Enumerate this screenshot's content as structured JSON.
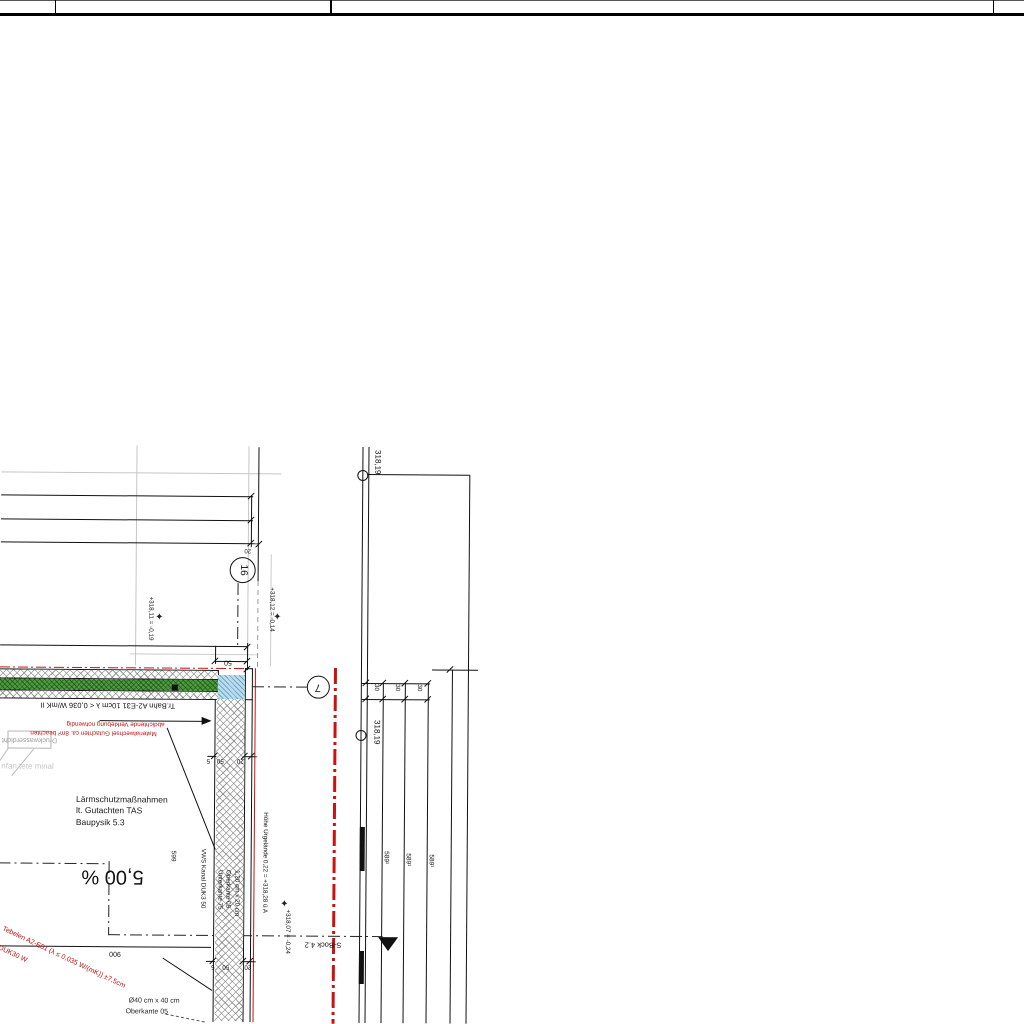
{
  "sheet": {
    "kind": "architectural-section-detail",
    "background": "#ffffff"
  },
  "colors": {
    "ink": "#111111",
    "red": "#c11212",
    "gray": "#9a9a9a",
    "faint": "#c4c4c4",
    "green_layer": "#4f9c40",
    "blue_block": "#badcef"
  },
  "title_block": {
    "top_rule_y": 0,
    "main_rule_y": 13,
    "dividers_x": [
      55,
      330,
      993
    ]
  },
  "texts": [
    {
      "n": "laermschutz-note",
      "t": "Lärmschutzmaßnahmen\nlt. Gutachten TAS\nBaupysik 5.3",
      "x": 77,
      "y": 797,
      "rot": 0,
      "fs": 8.5,
      "c": "#1a1a1a",
      "align": "l",
      "lh": 1.35
    },
    {
      "n": "slope-label",
      "t": "5,00 %",
      "x": 114,
      "y": 879,
      "rot": 180,
      "fs": 20,
      "c": "#111111",
      "align": "c"
    },
    {
      "n": "spec-trennbahn",
      "t": "Tr.Bahn A2-E31 10cm λ < 0,036 W/mK II",
      "x": 108,
      "y": 708,
      "rot": 180,
      "fs": 7.5,
      "c": "#111111",
      "align": "c"
    },
    {
      "n": "red-note-line1",
      "t": "abdichtende Verklebung notwendig",
      "x": 116,
      "y": 726,
      "rot": 180,
      "fs": 6.3,
      "c": "#c11212",
      "align": "c"
    },
    {
      "n": "red-note-line2",
      "t": "Materialwechsel Gutachten ca. 8m² beachten",
      "x": 94,
      "y": 735,
      "rot": 180,
      "fs": 6.3,
      "c": "#c11212",
      "align": "c"
    },
    {
      "n": "druckwasser-label",
      "t": "Druckwasserdicht",
      "x": 30,
      "y": 743,
      "rot": 180,
      "fs": 7,
      "c": "#9a9a9a",
      "align": "c"
    },
    {
      "n": "faint-ghost-text",
      "t": "nfan tete minal",
      "x": 2,
      "y": 766,
      "rot": 0,
      "fs": 8,
      "c": "#c4c4c4",
      "align": "l"
    },
    {
      "n": "red-diag-spec",
      "t": "Tebelen A2-E51 (λ ≤ 0,035 W/(mK)) ±7,5cm",
      "x": 6,
      "y": 929,
      "rot": 25,
      "fs": 7,
      "c": "#c11212",
      "align": "l"
    },
    {
      "n": "red-diag-spec2",
      "t": "DUK30 W",
      "x": 2,
      "y": 948,
      "rot": 25,
      "fs": 7,
      "c": "#c11212",
      "align": "l"
    },
    {
      "n": "dim-900",
      "t": "900",
      "x": 117,
      "y": 956,
      "rot": 180,
      "fs": 7,
      "c": "#111111",
      "align": "c"
    },
    {
      "n": "dim-50",
      "t": "50",
      "x": 228,
      "y": 664,
      "rot": 180,
      "fs": 7,
      "c": "#111111",
      "align": "c"
    },
    {
      "n": "dim-20-top",
      "t": "20",
      "x": 247,
      "y": 552,
      "rot": 180,
      "fs": 6,
      "c": "#111111",
      "align": "c"
    },
    {
      "n": "wall-dim-5a",
      "t": "5",
      "x": 209,
      "y": 762,
      "rot": 180,
      "fs": 6.3,
      "c": "#111111",
      "align": "c"
    },
    {
      "n": "wall-dim-50a",
      "t": "50",
      "x": 221,
      "y": 762,
      "rot": 180,
      "fs": 6.3,
      "c": "#111111",
      "align": "c"
    },
    {
      "n": "wall-dim-20a",
      "t": "20",
      "x": 241,
      "y": 762,
      "rot": 180,
      "fs": 6.3,
      "c": "#111111",
      "align": "c"
    },
    {
      "n": "wall-dim-5b",
      "t": "5",
      "x": 215,
      "y": 968,
      "rot": 180,
      "fs": 6.3,
      "c": "#111111",
      "align": "c"
    },
    {
      "n": "wall-dim-50b",
      "t": "50",
      "x": 228,
      "y": 968,
      "rot": 180,
      "fs": 6.3,
      "c": "#111111",
      "align": "c"
    },
    {
      "n": "wall-dim-20b",
      "t": "20",
      "x": 250,
      "y": 968,
      "rot": 180,
      "fs": 6.3,
      "c": "#111111",
      "align": "c"
    },
    {
      "n": "marker-16-label",
      "t": "16",
      "x": 242,
      "y": 572,
      "rot": 90,
      "fs": 10,
      "c": "#111111",
      "align": "c"
    },
    {
      "n": "marker-7-label",
      "t": "7",
      "x": 318,
      "y": 688,
      "rot": 180,
      "fs": 11,
      "c": "#111111",
      "align": "c"
    },
    {
      "n": "level-318-19-a",
      "t": "318,19",
      "x": 380,
      "y": 451,
      "rot": 90,
      "fs": 8,
      "c": "#111111",
      "align": "l"
    },
    {
      "n": "level-318-19-b",
      "t": "318,19",
      "x": 381,
      "y": 721,
      "rot": 90,
      "fs": 8,
      "c": "#111111",
      "align": "l"
    },
    {
      "n": "datum-left",
      "t": "+318,11 = -0,19",
      "x": 153,
      "y": 599,
      "rot": 90,
      "fs": 6.3,
      "c": "#111111",
      "align": "l"
    },
    {
      "n": "datum-right",
      "t": "+318,12 = -0,14",
      "x": 274,
      "y": 589,
      "rot": 90,
      "fs": 6.3,
      "c": "#111111",
      "align": "l"
    },
    {
      "n": "hoehe-urgelaende",
      "t": "Höhe Urgelände 0,22 = +318,28 ü A",
      "x": 269,
      "y": 814,
      "rot": 90,
      "fs": 6.3,
      "c": "#111111",
      "align": "l"
    },
    {
      "n": "datum-low",
      "t": "+318,07 = -0,24",
      "x": 292,
      "y": 911,
      "rot": 90,
      "fs": 6.3,
      "c": "#111111",
      "align": "l"
    },
    {
      "n": "dim-30-a",
      "t": "30",
      "x": 379,
      "y": 685,
      "rot": 90,
      "fs": 6.3,
      "c": "#111111",
      "align": "l"
    },
    {
      "n": "dim-30-b",
      "t": "30",
      "x": 400,
      "y": 685,
      "rot": 90,
      "fs": 6.3,
      "c": "#111111",
      "align": "l"
    },
    {
      "n": "dim-30-c",
      "t": "30",
      "x": 422,
      "y": 685,
      "rot": 90,
      "fs": 6.3,
      "c": "#111111",
      "align": "l"
    },
    {
      "n": "level-589-a",
      "t": "589¹",
      "x": 390,
      "y": 852,
      "rot": 90,
      "fs": 6.5,
      "c": "#111111",
      "align": "l"
    },
    {
      "n": "level-589-b",
      "t": "589¹",
      "x": 412,
      "y": 854,
      "rot": 90,
      "fs": 6.5,
      "c": "#111111",
      "align": "l"
    },
    {
      "n": "level-589-c",
      "t": "589¹",
      "x": 435,
      "y": 855,
      "rot": 90,
      "fs": 6.5,
      "c": "#111111",
      "align": "l"
    },
    {
      "n": "level-599",
      "t": "599",
      "x": 177,
      "y": 853,
      "rot": 90,
      "fs": 6.5,
      "c": "#111111",
      "align": "l"
    },
    {
      "n": "vws-kanal-label",
      "t": "VWS Kanal DUK3 50",
      "x": 207,
      "y": 851,
      "rot": 90,
      "fs": 6.3,
      "c": "#111111",
      "align": "l"
    },
    {
      "n": "wall-column-label",
      "t": "1,20 cm x 20 cm\nOberkante 05\nUnterkante 75",
      "x": 242,
      "y": 872,
      "rot": 90,
      "fs": 6.3,
      "c": "#111111",
      "align": "l",
      "lh": 1.35
    },
    {
      "n": "section-label",
      "t": "S-Bock 4.2",
      "x": 325,
      "y": 946,
      "rot": 180,
      "fs": 7.5,
      "c": "#111111",
      "align": "c"
    },
    {
      "n": "footing-size-label",
      "t": "Ø40 cm x 40 cm",
      "x": 131,
      "y": 1000,
      "rot": 0,
      "fs": 7,
      "c": "#222222",
      "align": "l"
    },
    {
      "n": "footing-okante-label",
      "t": "Oberkante 05",
      "x": 128,
      "y": 1011,
      "rot": 0,
      "fs": 7,
      "c": "#222222",
      "align": "l"
    }
  ],
  "lines": [
    {
      "n": "title-top-rule",
      "x": 0,
      "y": 0,
      "l": 1024,
      "w": 1,
      "o": "h",
      "c": "#555"
    },
    {
      "n": "title-main-rule",
      "x": 0,
      "y": 13,
      "l": 1024,
      "w": 2.5,
      "o": "h",
      "c": "#000"
    },
    {
      "n": "title-divider-1",
      "x": 55,
      "y": 0,
      "l": 14,
      "w": 1,
      "o": "v",
      "c": "#000"
    },
    {
      "n": "title-divider-2",
      "x": 330,
      "y": 0,
      "l": 14,
      "w": 1.5,
      "o": "v",
      "c": "#000"
    },
    {
      "n": "title-divider-3",
      "x": 993,
      "y": 0,
      "l": 14,
      "w": 1,
      "o": "v",
      "c": "#000"
    },
    {
      "n": "grid-gray-v1",
      "x": 135,
      "y": 448,
      "l": 220,
      "w": 1,
      "o": "v",
      "c": "#c6c6c6"
    },
    {
      "n": "grid-gray-v2",
      "x": 247,
      "y": 448,
      "l": 222,
      "w": 1,
      "o": "v",
      "c": "#c6c6c6"
    },
    {
      "n": "grid-gray-v3",
      "x": 270,
      "y": 556,
      "l": 112,
      "w": 1,
      "o": "v",
      "c": "#cccccc"
    },
    {
      "n": "grid-gray-h1",
      "x": 0,
      "y": 475,
      "l": 280,
      "w": 1,
      "o": "h",
      "c": "#c6c6c6"
    },
    {
      "n": "grid-gray-h2",
      "x": 130,
      "y": 656,
      "l": 128,
      "w": 1,
      "o": "h",
      "c": "#cccccc"
    },
    {
      "n": "ramp-line-1",
      "x": 0,
      "y": 498,
      "l": 252,
      "w": 1.2,
      "o": "h",
      "c": "#111"
    },
    {
      "n": "ramp-line-2",
      "x": 0,
      "y": 522,
      "l": 252,
      "w": 1.2,
      "o": "h",
      "c": "#111"
    },
    {
      "n": "ramp-line-3",
      "x": 0,
      "y": 545,
      "l": 258,
      "w": 1.2,
      "o": "h",
      "c": "#111"
    },
    {
      "n": "ramp-dim-v",
      "x": 250,
      "y": 497,
      "l": 52,
      "w": 1,
      "o": "v",
      "c": "#111"
    },
    {
      "n": "ramp-edge-v",
      "x": 257,
      "y": 449,
      "l": 134,
      "w": 1.2,
      "o": "v",
      "c": "#111"
    },
    {
      "n": "ramp-edge-dash",
      "x": 257,
      "y": 583,
      "l": 88,
      "w": 1,
      "o": "v",
      "c": "#999",
      "d": "graydashv"
    },
    {
      "n": "axis-dashdot-16",
      "x": 237,
      "y": 585,
      "l": 63,
      "w": 1,
      "o": "v",
      "c": "#222",
      "d": "dashdotv"
    },
    {
      "n": "floor-top-line",
      "x": 0,
      "y": 648,
      "l": 247,
      "w": 1,
      "o": "h",
      "c": "#111"
    },
    {
      "n": "dim-50-line",
      "x": 215,
      "y": 663,
      "l": 32,
      "w": 1,
      "o": "h",
      "c": "#111"
    },
    {
      "n": "ext-v-215",
      "x": 215,
      "y": 648,
      "l": 18,
      "w": 1,
      "o": "v",
      "c": "#111"
    },
    {
      "n": "ext-v-247",
      "x": 247,
      "y": 645,
      "l": 27,
      "w": 1,
      "o": "v",
      "c": "#111"
    },
    {
      "n": "band-red-top",
      "x": 0,
      "y": 670,
      "l": 250,
      "w": 1.4,
      "o": "h",
      "c": "#c11",
      "d": "reddashdot"
    },
    {
      "n": "band-border-1",
      "x": 0,
      "y": 672,
      "l": 218,
      "w": 1,
      "o": "h",
      "c": "#111"
    },
    {
      "n": "band-border-2",
      "x": 0,
      "y": 681,
      "l": 218,
      "w": 1,
      "o": "h",
      "c": "#111"
    },
    {
      "n": "band-border-3",
      "x": 0,
      "y": 693,
      "l": 246,
      "w": 1,
      "o": "h",
      "c": "#111"
    },
    {
      "n": "band-border-4",
      "x": 0,
      "y": 701,
      "l": 253,
      "w": 1.2,
      "o": "h",
      "c": "#111"
    },
    {
      "n": "band-corner-h",
      "x": 245,
      "y": 670,
      "l": 8,
      "w": 1,
      "o": "h",
      "c": "#111"
    },
    {
      "n": "band-arrow-line",
      "x": 170,
      "y": 683,
      "l": 48,
      "w": 1.2,
      "o": "h",
      "c": "#111"
    },
    {
      "n": "blue-border-l",
      "x": 218,
      "y": 672,
      "l": 29,
      "w": 1,
      "o": "v",
      "c": "#111"
    },
    {
      "n": "blue-border-r",
      "x": 245,
      "y": 670,
      "l": 31,
      "w": 1,
      "o": "v",
      "c": "#111"
    },
    {
      "n": "band-border-r2",
      "x": 252,
      "y": 670,
      "l": 31,
      "w": 1.2,
      "o": "v",
      "c": "#111"
    },
    {
      "n": "leader-red-note",
      "x": 100,
      "y": 723,
      "l": 105,
      "w": 1,
      "o": "h",
      "c": "#111"
    },
    {
      "n": "wall-face-left",
      "x": 215,
      "y": 701,
      "l": 323,
      "w": 1.2,
      "o": "v",
      "c": "#111"
    },
    {
      "n": "wall-line-245",
      "x": 245,
      "y": 701,
      "l": 323,
      "w": 1,
      "o": "v",
      "c": "#111"
    },
    {
      "n": "wall-face-right",
      "x": 252,
      "y": 701,
      "l": 323,
      "w": 1.2,
      "o": "v",
      "c": "#111"
    },
    {
      "n": "wall-red-seal",
      "x": 255,
      "y": 670,
      "l": 354,
      "w": 1.4,
      "o": "v",
      "c": "#c11"
    },
    {
      "n": "wall-axis-dashdot",
      "x": 231,
      "y": 700,
      "l": 324,
      "w": 1,
      "o": "v",
      "c": "#222",
      "d": "dashdotv"
    },
    {
      "n": "wall-dim-line-a",
      "x": 208,
      "y": 758,
      "l": 50,
      "w": 1,
      "o": "h",
      "c": "#111"
    },
    {
      "n": "wall-dim-line-b",
      "x": 208,
      "y": 963,
      "l": 50,
      "w": 1,
      "o": "h",
      "c": "#111"
    },
    {
      "n": "marker7-leader",
      "x": 252,
      "y": 688,
      "l": 55,
      "w": 1,
      "o": "h",
      "c": "#222",
      "d": "dashdot"
    },
    {
      "n": "boundary-red-bold",
      "x": 334,
      "y": 669,
      "l": 356,
      "w": 2.6,
      "o": "v",
      "c": "#c11",
      "d": "reddashdotv"
    },
    {
      "n": "level-line-1",
      "x": 361,
      "y": 448,
      "l": 576,
      "w": 1.2,
      "o": "v",
      "c": "#111"
    },
    {
      "n": "level-line-2",
      "x": 367,
      "y": 448,
      "l": 576,
      "w": 1,
      "o": "v",
      "c": "#111"
    },
    {
      "n": "level-bold-seg1",
      "x": 361,
      "y": 828,
      "l": 44,
      "w": 5,
      "o": "v",
      "c": "#111"
    },
    {
      "n": "level-bold-seg2",
      "x": 361,
      "y": 952,
      "l": 33,
      "w": 5,
      "o": "v",
      "c": "#111"
    },
    {
      "n": "level-top-h",
      "x": 366,
      "y": 475,
      "l": 102,
      "w": 1,
      "o": "h",
      "c": "#111"
    },
    {
      "n": "right-edge-v",
      "x": 468,
      "y": 475,
      "l": 549,
      "w": 1.2,
      "o": "v",
      "c": "#111"
    },
    {
      "n": "right-h-670",
      "x": 432,
      "y": 670,
      "l": 46,
      "w": 1,
      "o": "h",
      "c": "#111"
    },
    {
      "n": "right-v-452",
      "x": 452,
      "y": 670,
      "l": 354,
      "w": 1,
      "o": "v",
      "c": "#111"
    },
    {
      "n": "dim30-line-a",
      "x": 362,
      "y": 684,
      "l": 68,
      "w": 1,
      "o": "h",
      "c": "#111"
    },
    {
      "n": "dim30-line-b",
      "x": 362,
      "y": 700,
      "l": 68,
      "w": 1,
      "o": "h",
      "c": "#111"
    },
    {
      "n": "ext-v-383",
      "x": 383,
      "y": 684,
      "l": 340,
      "w": 1,
      "o": "v",
      "c": "#111"
    },
    {
      "n": "ext-v-405",
      "x": 405,
      "y": 684,
      "l": 340,
      "w": 1,
      "o": "v",
      "c": "#111"
    },
    {
      "n": "ext-v-428",
      "x": 428,
      "y": 684,
      "l": 340,
      "w": 1,
      "o": "v",
      "c": "#111"
    },
    {
      "n": "slope-dashdot-h1",
      "x": 0,
      "y": 866,
      "l": 110,
      "w": 1,
      "o": "h",
      "c": "#222",
      "d": "dashdot"
    },
    {
      "n": "slope-dashdot-v",
      "x": 110,
      "y": 864,
      "l": 74,
      "w": 1,
      "o": "v",
      "c": "#222",
      "d": "dashdotv"
    },
    {
      "n": "slope-dashdot-h2",
      "x": 110,
      "y": 937,
      "l": 275,
      "w": 1,
      "o": "h",
      "c": "#222",
      "d": "dashdot"
    },
    {
      "n": "dim-900-line",
      "x": 0,
      "y": 949,
      "l": 213,
      "w": 1,
      "o": "h",
      "c": "#111"
    }
  ],
  "diagonals": [
    {
      "n": "leader-diag-1",
      "x": 168,
      "y": 730,
      "len": 131,
      "ang": 68,
      "w": 1,
      "c": "#111"
    },
    {
      "n": "leader-diag-2",
      "x": 165,
      "y": 960,
      "len": 59,
      "ang": 33,
      "w": 1,
      "c": "#111"
    },
    {
      "n": "leader-diag-dashed",
      "x": 168,
      "y": 1016,
      "len": 40,
      "ang": 11,
      "w": 1,
      "c": "#555",
      "dash": true
    },
    {
      "n": "gray-leader-1",
      "x": 12,
      "y": 779,
      "len": 35,
      "ang": -51,
      "w": 1,
      "c": "#bbb"
    },
    {
      "n": "gray-leader-2",
      "x": 0,
      "y": 764,
      "len": 15,
      "ang": -56,
      "w": 1,
      "c": "#bbb"
    }
  ],
  "rects": [
    {
      "n": "layer-hatch-top",
      "x": 0,
      "y": 673,
      "w": 218,
      "h": 8,
      "cls": "mesh"
    },
    {
      "n": "layer-green",
      "x": 0,
      "y": 682,
      "w": 218,
      "h": 11,
      "cls": "green"
    },
    {
      "n": "layer-hatch-bottom",
      "x": 0,
      "y": 694,
      "w": 218,
      "h": 7,
      "cls": "mesh"
    },
    {
      "n": "layer-blue-block",
      "x": 218,
      "y": 677,
      "w": 27,
      "h": 24,
      "cls": "blue"
    },
    {
      "n": "wall-insulation-hatch",
      "x": 217,
      "y": 701,
      "w": 28,
      "h": 322,
      "cls": "mesh"
    },
    {
      "n": "green-arrow-square",
      "x": 172,
      "y": 687,
      "w": 6,
      "h": 6,
      "cls": "solidink"
    },
    {
      "n": "druckwasser-box",
      "x": 8,
      "y": 734,
      "w": 44,
      "h": 18,
      "cls": "box"
    }
  ],
  "circles": [
    {
      "n": "marker-16-circle",
      "x": 229,
      "y": 559,
      "d": 26
    },
    {
      "n": "marker-7-circle",
      "x": 307,
      "y": 677,
      "d": 23
    },
    {
      "n": "level-node-a",
      "x": 356,
      "y": 471,
      "d": 11
    },
    {
      "n": "level-node-b",
      "x": 356,
      "y": 731,
      "d": 11
    }
  ],
  "triangles": [
    {
      "n": "red-note-arrowhead",
      "x": 202,
      "y": 719,
      "kind": "right",
      "w": 10,
      "h": 9
    },
    {
      "n": "section-arrow",
      "x": 380,
      "y": 938,
      "kind": "down",
      "w": 20,
      "h": 14
    }
  ],
  "stars": [
    {
      "n": "datum-cross-left",
      "x": 159,
      "y": 620
    },
    {
      "n": "datum-cross-right",
      "x": 277,
      "y": 619
    },
    {
      "n": "datum-cross-low",
      "x": 286,
      "y": 906
    }
  ],
  "ticks": [
    [
      250,
      498
    ],
    [
      250,
      522
    ],
    [
      250,
      545
    ],
    [
      258,
      546
    ],
    [
      215,
      663
    ],
    [
      247,
      663
    ],
    [
      247,
      649
    ],
    [
      247,
      671
    ],
    [
      215,
      758
    ],
    [
      245,
      758
    ],
    [
      252,
      758
    ],
    [
      215,
      963
    ],
    [
      245,
      963
    ],
    [
      252,
      963
    ],
    [
      366,
      684
    ],
    [
      383,
      684
    ],
    [
      405,
      684
    ],
    [
      428,
      684
    ],
    [
      366,
      700
    ],
    [
      383,
      700
    ],
    [
      405,
      700
    ],
    [
      428,
      700
    ],
    [
      450,
      670
    ]
  ]
}
